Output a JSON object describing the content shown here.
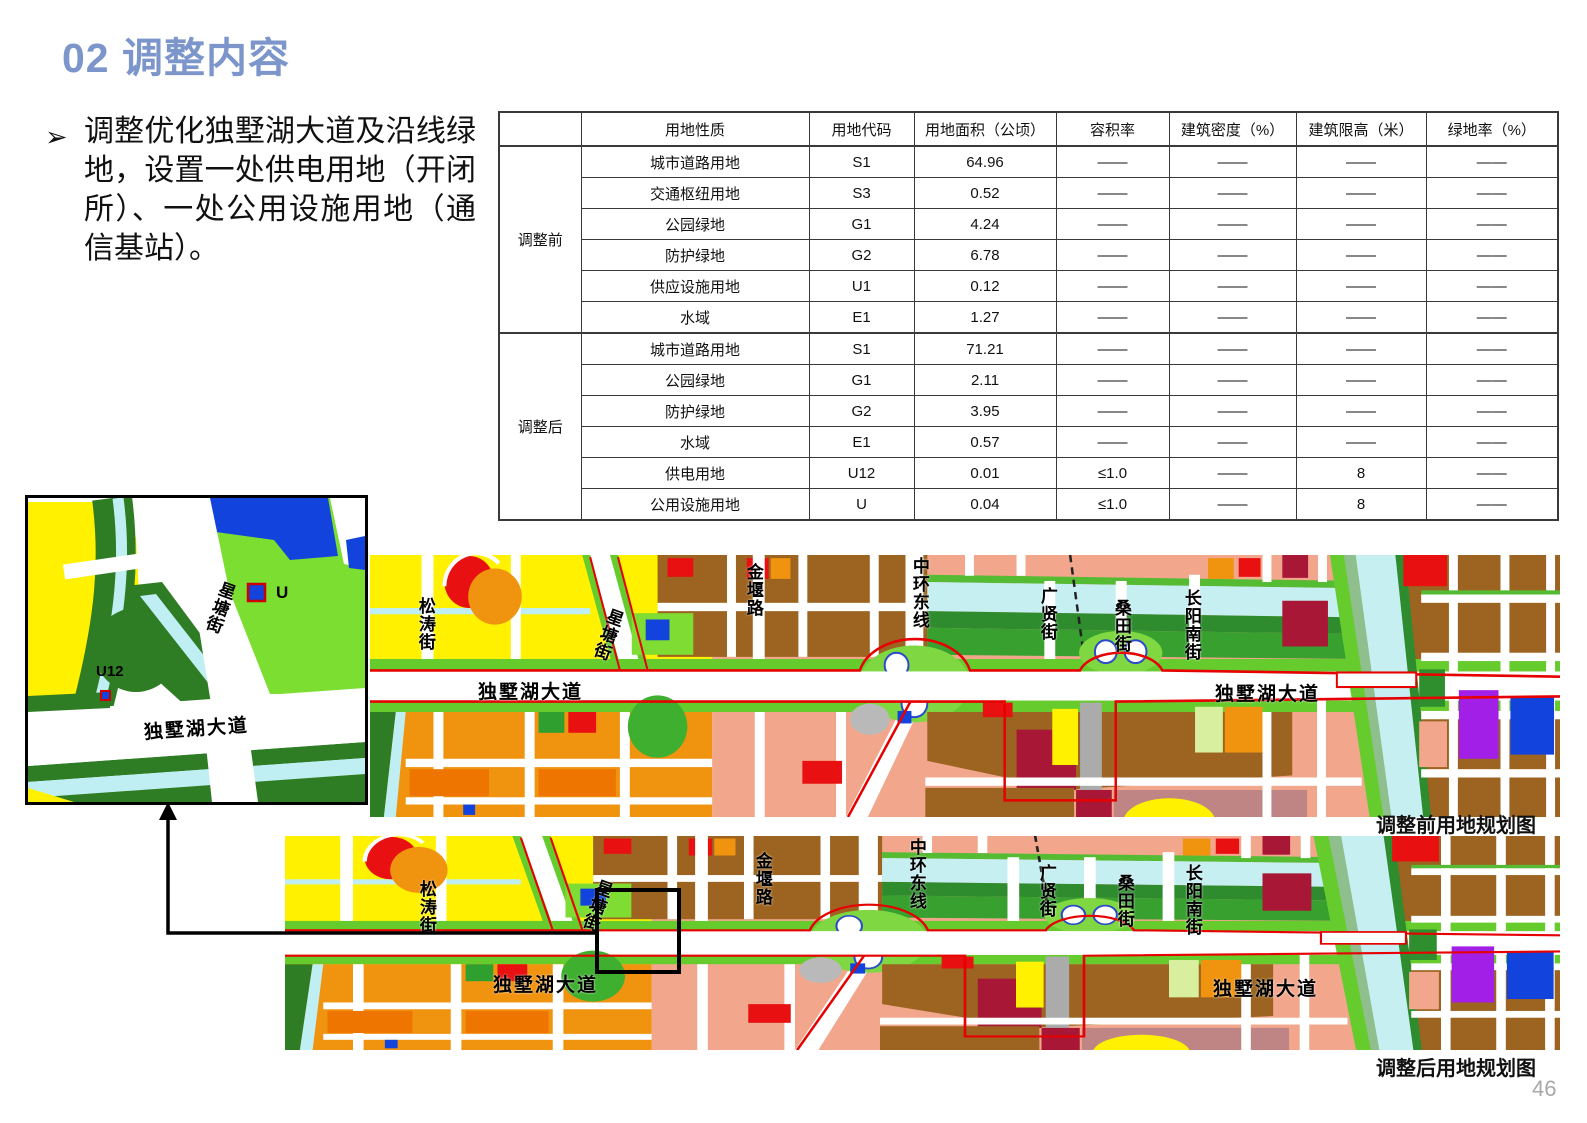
{
  "slide": {
    "title": "02 调整内容",
    "bullet_marker": "➢",
    "bullet_text": "调整优化独墅湖大道及沿线绿地，设置一处供电用地（开闭所）、一处公用设施用地（通信基站）。",
    "page_number": "46"
  },
  "table": {
    "headers": [
      "",
      "用地性质",
      "用地代码",
      "用地面积（公顷）",
      "容积率",
      "建筑密度（%）",
      "建筑限高（米）",
      "绿地率（%）"
    ],
    "groups": [
      {
        "label": "调整前",
        "rows": [
          [
            "城市道路用地",
            "S1",
            "64.96",
            "——",
            "——",
            "——",
            "——"
          ],
          [
            "交通枢纽用地",
            "S3",
            "0.52",
            "——",
            "——",
            "——",
            "——"
          ],
          [
            "公园绿地",
            "G1",
            "4.24",
            "——",
            "——",
            "——",
            "——"
          ],
          [
            "防护绿地",
            "G2",
            "6.78",
            "——",
            "——",
            "——",
            "——"
          ],
          [
            "供应设施用地",
            "U1",
            "0.12",
            "——",
            "——",
            "——",
            "——"
          ],
          [
            "水域",
            "E1",
            "1.27",
            "——",
            "——",
            "——",
            "——"
          ]
        ]
      },
      {
        "label": "调整后",
        "rows": [
          [
            "城市道路用地",
            "S1",
            "71.21",
            "——",
            "——",
            "——",
            "——"
          ],
          [
            "公园绿地",
            "G1",
            "2.11",
            "——",
            "——",
            "——",
            "——"
          ],
          [
            "防护绿地",
            "G2",
            "3.95",
            "——",
            "——",
            "——",
            "——"
          ],
          [
            "水域",
            "E1",
            "0.57",
            "——",
            "——",
            "——",
            "——"
          ],
          [
            "供电用地",
            "U12",
            "0.01",
            "≤1.0",
            "——",
            "8",
            "——"
          ],
          [
            "公用设施用地",
            "U",
            "0.04",
            "≤1.0",
            "——",
            "8",
            "——"
          ]
        ]
      }
    ]
  },
  "maps": {
    "streets": {
      "songtao": "松涛街",
      "xingtang": "星塘街",
      "jinyan": "金堰路",
      "zhonghuan": "中环东线",
      "guangxian": "广贤街",
      "sangtian": "桑田街",
      "changyangnan": "长阳南街",
      "dushu": "独墅湖大道"
    },
    "before": {
      "caption": "调整前用地规划图"
    },
    "after": {
      "caption": "调整后用地规划图"
    },
    "inset": {
      "u_label": "U",
      "u12_label": "U12"
    },
    "colors": {
      "residential_yellow": "#FFF100",
      "commercial_salmon": "#F2A78D",
      "industrial_brown": "#9C6420",
      "orange_mixed": "#F0930F",
      "park_green": "#7EDC32",
      "protective_green": "#2E7D25",
      "water_cyan": "#C6EFF2",
      "utility_blue": "#1243DC",
      "special_purple": "#A21FE8",
      "civic_crimson": "#A81735",
      "red_parcel": "#E81010",
      "scope_line_red": "#E60000",
      "title_blue": "#7C96CB"
    }
  }
}
